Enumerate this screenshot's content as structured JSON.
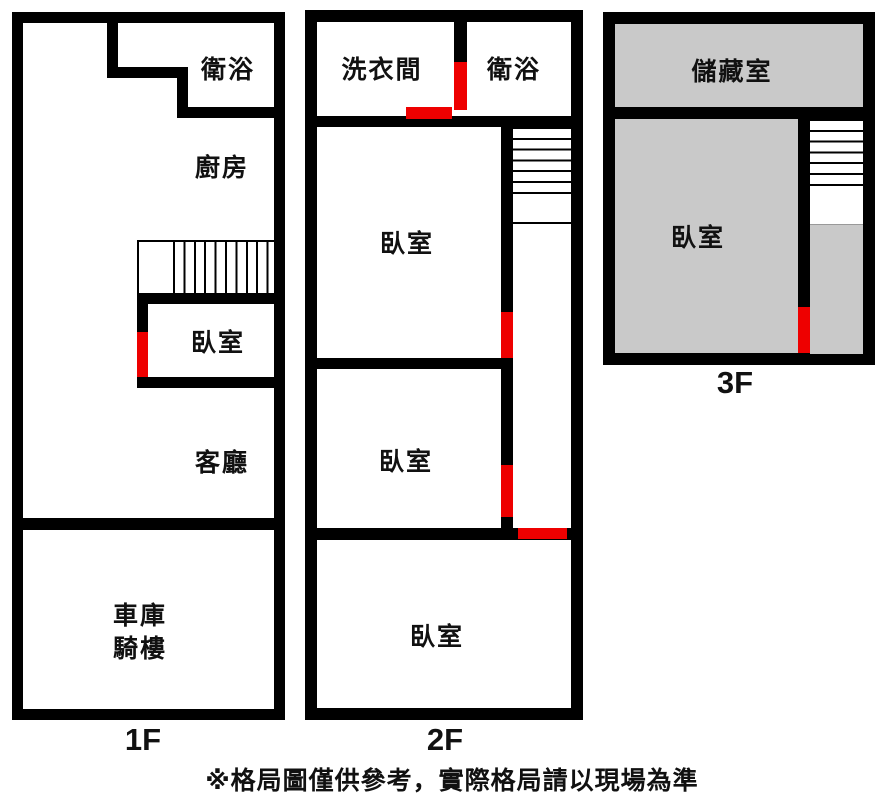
{
  "colors": {
    "wall": "#000000",
    "door": "#ee0000",
    "room_fill": "#c9c9c9",
    "background": "#ffffff",
    "text": "#111111"
  },
  "floor1": {
    "label": "1F",
    "bathroom": "衛浴",
    "kitchen": "廚房",
    "bedroom": "臥室",
    "living": "客廳",
    "garage_line1": "車庫",
    "garage_line2": "騎樓"
  },
  "floor2": {
    "label": "2F",
    "laundry": "洗衣間",
    "bathroom": "衛浴",
    "bedroom1": "臥室",
    "bedroom2": "臥室",
    "bedroom3": "臥室"
  },
  "floor3": {
    "label": "3F",
    "storage": "儲藏室",
    "bedroom": "臥室"
  },
  "footnote": "※格局圖僅供參考，實際格局請以現場為準"
}
